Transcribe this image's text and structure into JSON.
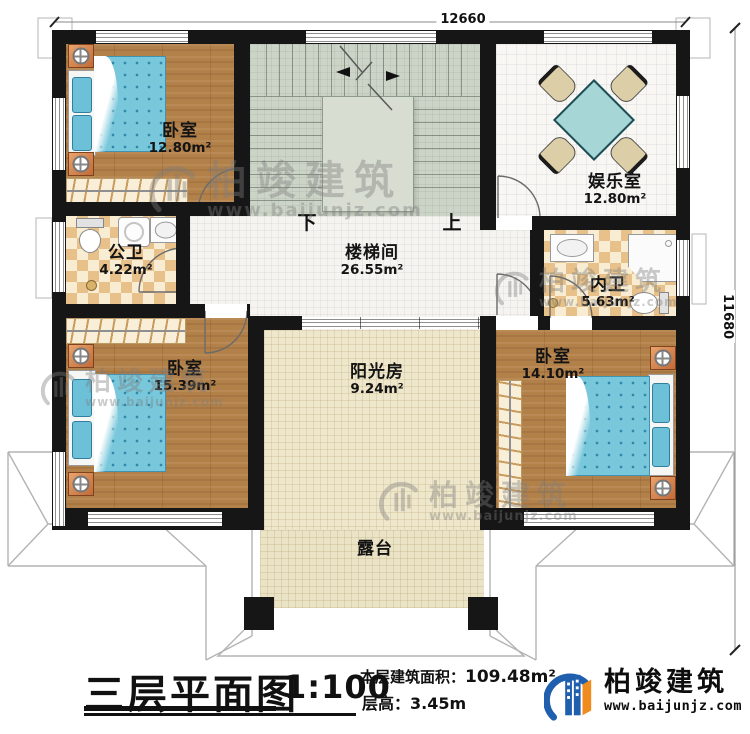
{
  "page": {
    "type": "architectural-floor-plan"
  },
  "dimensions": {
    "top": "12660",
    "right": "11680"
  },
  "rooms": [
    {
      "key": "bedroom-top-left",
      "name": "卧室",
      "area": "12.80m²"
    },
    {
      "key": "entertainment-room",
      "name": "娱乐室",
      "area": "12.80m²"
    },
    {
      "key": "public-bathroom",
      "name": "公卫",
      "area": "4.22m²"
    },
    {
      "key": "stair-hall",
      "name": "楼梯间",
      "area": "26.55m²"
    },
    {
      "key": "inner-bathroom",
      "name": "内卫",
      "area": "5.63m²"
    },
    {
      "key": "bedroom-bottom-left",
      "name": "卧室",
      "area": "15.39m²"
    },
    {
      "key": "bedroom-bottom-right",
      "name": "卧室",
      "area": "14.10m²"
    },
    {
      "key": "sunroom",
      "name": "阳光房",
      "area": "9.24m²"
    },
    {
      "key": "terrace",
      "name": "露台",
      "area": ""
    }
  ],
  "stairs": {
    "down": "下",
    "up": "上"
  },
  "title_block": {
    "title": "三层平面图",
    "scale": "1:100",
    "floor_area_label": "本层建筑面积：",
    "floor_area_value": "109.48m²",
    "floor_height_label": "层高：",
    "floor_height_value": "3.45m"
  },
  "brand": {
    "name": "柏竣建筑",
    "website": "www.baijunjz.com"
  },
  "watermark": {
    "name": "柏竣建筑",
    "website": "www.baijunjz.com"
  },
  "colors": {
    "wall": "#161616",
    "wood_floor": "#b28049",
    "bathroom_tile": "#e7c189",
    "stair_floor": "#ccd4c7",
    "bed": "#79c7db",
    "table": "#a7d6d6",
    "sunroom_floor": "#eee7cb",
    "brand_blue": "#1f5fae",
    "brand_orange": "#f08c1e"
  }
}
